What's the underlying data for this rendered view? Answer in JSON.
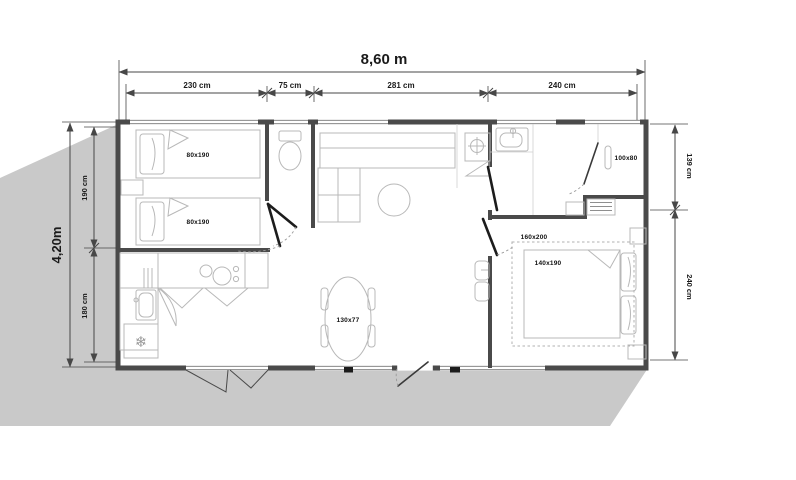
{
  "dims": {
    "overall_width": "8,60 m",
    "overall_depth": "4,20m",
    "top": [
      "230 cm",
      "75 cm",
      "281 cm",
      "240 cm"
    ],
    "left": [
      "190 cm",
      "180 cm"
    ],
    "right": [
      "139 cm",
      "240 cm"
    ]
  },
  "furniture": {
    "bed1": "80x190",
    "bed2": "80x190",
    "shower": "100x80",
    "double_bed_frame": "160x200",
    "double_bed_mattress": "140x190",
    "dining_table": "130x77",
    "fridge_icon": "❄"
  },
  "colors": {
    "shadow": "#c9c9c9",
    "wall": "#4a4a4a",
    "furniture_line": "#b8b8b8",
    "dimension_line": "#474747",
    "text": "#1a1a1a"
  }
}
